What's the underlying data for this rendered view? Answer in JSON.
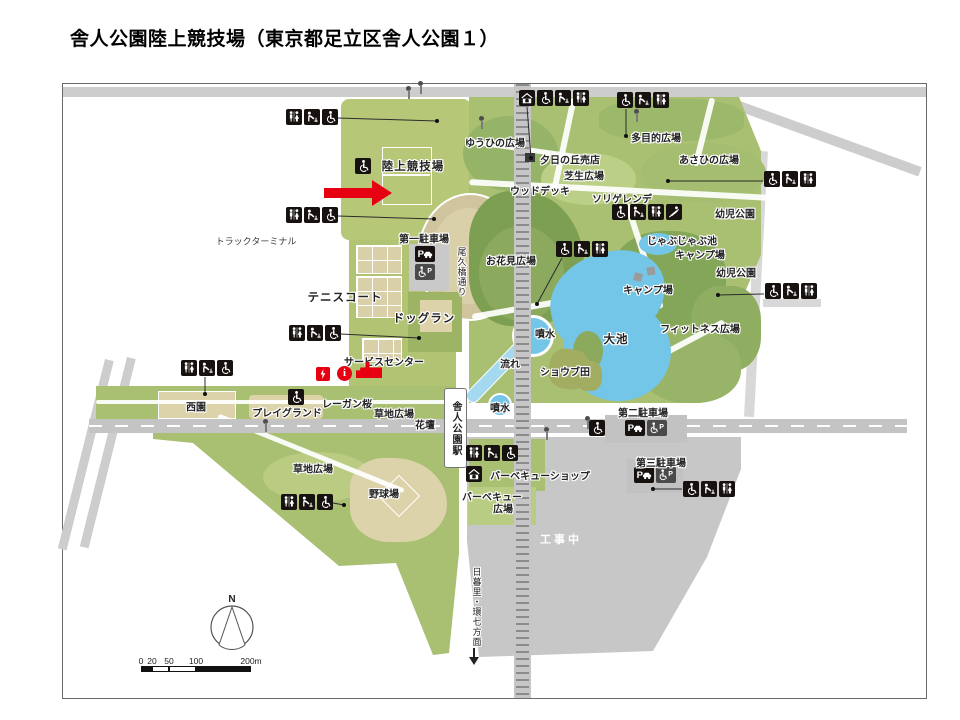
{
  "title": "舎人公園陸上競技場（東京都足立区舎人公園１）",
  "colors": {
    "highlight_red": "#e60012",
    "park_green": "#a9bf72",
    "pond_blue": "#74c6e8"
  },
  "map": {
    "station_label": "舎人公園駅",
    "compass": {
      "north": "N"
    },
    "scale_bar": {
      "ticks": [
        "0",
        "20",
        "50",
        "100",
        "200m"
      ]
    },
    "labels": [
      {
        "t": "トラックターミナル",
        "x": 256,
        "y": 241,
        "c": "sm"
      },
      {
        "t": "陸上競技場",
        "x": 413,
        "y": 166,
        "c": "lg"
      },
      {
        "t": "第一駐車場",
        "x": 424,
        "y": 238
      },
      {
        "t": "テニスコート",
        "x": 345,
        "y": 297,
        "c": "lg"
      },
      {
        "t": "ドッグラン",
        "x": 424,
        "y": 318,
        "c": "lg"
      },
      {
        "t": "サービスセンター",
        "x": 384,
        "y": 361
      },
      {
        "t": "レーガン桜",
        "x": 347,
        "y": 403
      },
      {
        "t": "西園",
        "x": 196,
        "y": 406
      },
      {
        "t": "プレイグランド",
        "x": 287,
        "y": 412
      },
      {
        "t": "草地広場",
        "x": 394,
        "y": 413
      },
      {
        "t": "花壇",
        "x": 425,
        "y": 424
      },
      {
        "t": "草地広場",
        "x": 313,
        "y": 468
      },
      {
        "t": "野球場",
        "x": 384,
        "y": 493
      },
      {
        "t": "ゆうひの広場",
        "x": 495,
        "y": 142
      },
      {
        "t": "夕日の丘売店",
        "x": 570,
        "y": 159
      },
      {
        "t": "芝生広場",
        "x": 584,
        "y": 175
      },
      {
        "t": "ウッドデッキ",
        "x": 540,
        "y": 190
      },
      {
        "t": "ソリゲレンデ",
        "x": 622,
        "y": 198
      },
      {
        "t": "多目的広場",
        "x": 656,
        "y": 137
      },
      {
        "t": "あさひの広場",
        "x": 709,
        "y": 159
      },
      {
        "t": "幼児公園",
        "x": 735,
        "y": 213
      },
      {
        "t": "じゃぶじゃぶ池",
        "x": 682,
        "y": 240
      },
      {
        "t": "キャンプ場",
        "x": 700,
        "y": 254
      },
      {
        "t": "キャンプ場",
        "x": 648,
        "y": 289
      },
      {
        "t": "幼児公園",
        "x": 736,
        "y": 272
      },
      {
        "t": "フィットネス広場",
        "x": 700,
        "y": 328
      },
      {
        "t": "お花見広場",
        "x": 511,
        "y": 260
      },
      {
        "t": "噴水",
        "x": 545,
        "y": 333
      },
      {
        "t": "流れ",
        "x": 510,
        "y": 363
      },
      {
        "t": "ショウブ田",
        "x": 565,
        "y": 371
      },
      {
        "t": "大池",
        "x": 616,
        "y": 339,
        "c": "lg"
      },
      {
        "t": "噴水",
        "x": 500,
        "y": 407
      },
      {
        "t": "バーベキューショップ",
        "x": 540,
        "y": 475
      },
      {
        "t": "バーベキュー",
        "x": 492,
        "y": 496
      },
      {
        "t": "広場",
        "x": 503,
        "y": 508
      },
      {
        "t": "工事中",
        "x": 561,
        "y": 539,
        "c": "wh"
      },
      {
        "t": "第二駐車場",
        "x": 643,
        "y": 412
      },
      {
        "t": "第三駐車場",
        "x": 661,
        "y": 462
      },
      {
        "t": "尾久橋通り",
        "x": 462,
        "y": 272,
        "c": "v"
      },
      {
        "t": "日暮里・環七方面",
        "x": 477,
        "y": 607,
        "c": "v"
      }
    ],
    "icon_groups": [
      {
        "x": 286,
        "y": 109,
        "icons": [
          "toilet",
          "fountain",
          "wheelchair"
        ],
        "line": [
          338,
          118,
          437,
          121
        ]
      },
      {
        "x": 286,
        "y": 207,
        "icons": [
          "toilet",
          "fountain",
          "wheelchair"
        ],
        "line": [
          338,
          216,
          434,
          219
        ]
      },
      {
        "x": 289,
        "y": 325,
        "icons": [
          "toilet",
          "fountain",
          "wheelchair"
        ],
        "line": [
          341,
          334,
          419,
          338
        ]
      },
      {
        "x": 181,
        "y": 360,
        "icons": [
          "toilet",
          "fountain",
          "wheelchair"
        ],
        "line": [
          205,
          377,
          205,
          394
        ]
      },
      {
        "x": 281,
        "y": 494,
        "icons": [
          "toilet",
          "fountain",
          "wheelchair"
        ],
        "line": [
          333,
          503,
          344,
          505
        ]
      },
      {
        "x": 519,
        "y": 90,
        "icons": [
          "shop",
          "wheelchair",
          "fountain",
          "toilet"
        ],
        "line": [
          527,
          107,
          531,
          158
        ]
      },
      {
        "x": 617,
        "y": 92,
        "icons": [
          "wheelchair",
          "fountain",
          "toilet"
        ],
        "line": [
          626,
          109,
          626,
          136
        ]
      },
      {
        "x": 612,
        "y": 204,
        "icons": [
          "wheelchair",
          "fountain",
          "toilet",
          "sled"
        ]
      },
      {
        "x": 556,
        "y": 241,
        "icons": [
          "wheelchair",
          "fountain",
          "toilet"
        ],
        "line": [
          562,
          258,
          537,
          304
        ]
      },
      {
        "x": 764,
        "y": 171,
        "icons": [
          "wheelchair",
          "fountain",
          "toilet"
        ],
        "line": [
          763,
          181,
          668,
          181
        ]
      },
      {
        "x": 765,
        "y": 283,
        "icons": [
          "wheelchair",
          "fountain",
          "toilet"
        ],
        "line": [
          764,
          294,
          718,
          295
        ]
      },
      {
        "x": 589,
        "y": 420,
        "icons": [
          "wheelchair"
        ]
      },
      {
        "x": 625,
        "y": 420,
        "icons": [
          "pcar",
          "pwheel"
        ]
      },
      {
        "x": 634,
        "y": 467,
        "icons": [
          "pcar",
          "pwheel"
        ]
      },
      {
        "x": 683,
        "y": 481,
        "icons": [
          "wheelchair",
          "fountain",
          "toilet"
        ],
        "line": [
          682,
          489,
          653,
          489
        ]
      },
      {
        "x": 466,
        "y": 445,
        "icons": [
          "toilet",
          "fountain",
          "wheelchair"
        ]
      },
      {
        "x": 466,
        "y": 466,
        "icons": [
          "shop"
        ]
      },
      {
        "x": 415,
        "y": 246,
        "icons": [
          "pcar"
        ]
      },
      {
        "x": 415,
        "y": 264,
        "icons": [
          "pwheel"
        ]
      },
      {
        "x": 355,
        "y": 158,
        "icons": [
          "wheelchair"
        ]
      },
      {
        "x": 288,
        "y": 389,
        "icons": [
          "wheelchair"
        ]
      }
    ],
    "markers": [
      {
        "type": "aed",
        "x": 316,
        "y": 367
      },
      {
        "type": "info",
        "x": 337,
        "y": 366,
        "glyph": "i"
      },
      {
        "type": "building",
        "x": 356,
        "y": 362
      }
    ],
    "lamps": [
      [
        405,
        86
      ],
      [
        417,
        81
      ],
      [
        633,
        109
      ],
      [
        262,
        419
      ],
      [
        543,
        427
      ],
      [
        584,
        416
      ],
      [
        478,
        116
      ]
    ]
  }
}
